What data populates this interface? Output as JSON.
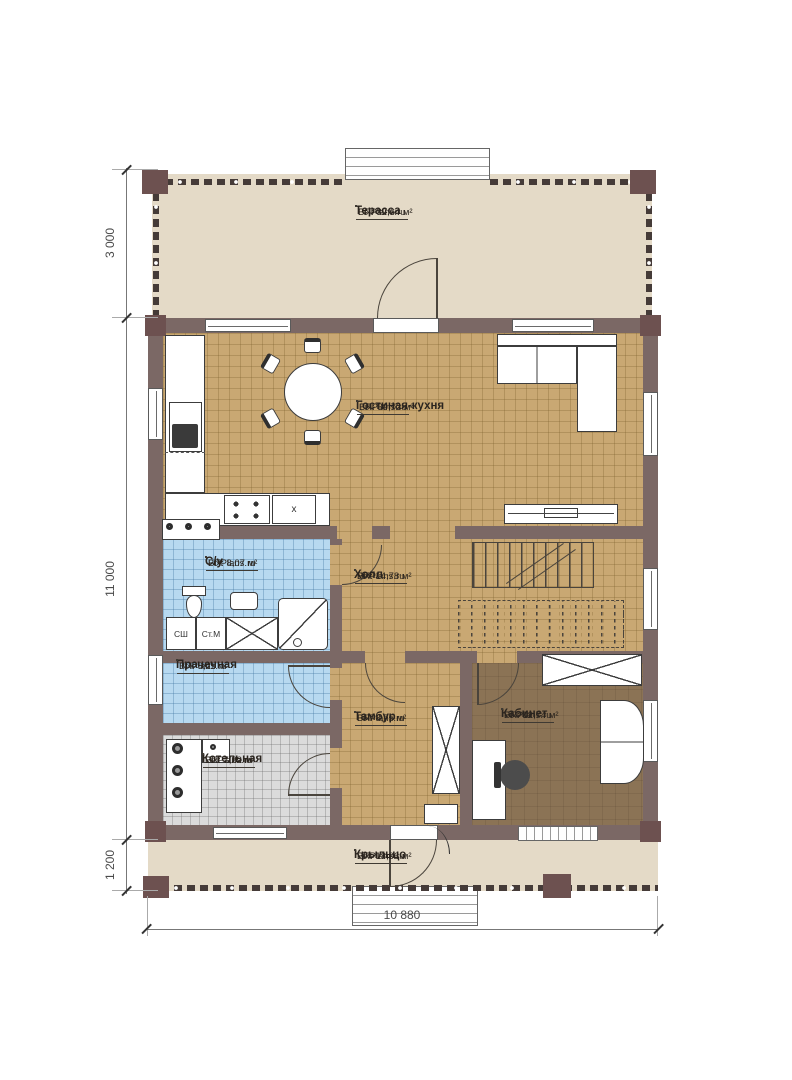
{
  "watermark": "FixPlans.ru",
  "rooms": {
    "terrace": {
      "name": "Терасса",
      "area": "ВП: 32,64 м²"
    },
    "living_kitchen": {
      "name": "Гостиная-кухня",
      "area": "ВП: 39,72 м²"
    },
    "bathroom": {
      "name": "С/у",
      "area": "ВП: 8,07 м²"
    },
    "hall": {
      "name": "Холл",
      "area": "ВП: 14,78 м²"
    },
    "laundry": {
      "name": "Прачечная",
      "area": "ВП: 6,11 м²"
    },
    "vestibule": {
      "name": "Тамбур",
      "area": "ВП: 8,75 м²"
    },
    "office": {
      "name": "Кабинет",
      "area": "ВП: 12,74 м²"
    },
    "boiler_room": {
      "name": "Котельная",
      "area": "ВП: 7,22 м²"
    },
    "porch": {
      "name": "Крыльцо",
      "area": "ВП: 13,06 м²"
    }
  },
  "annotations": {
    "closet": "СШ",
    "washing_machine": "Ст.М",
    "stove_mark": "x"
  },
  "dimensions": {
    "left_top": "3 000",
    "left_middle": "11 000",
    "left_bottom": "1 200",
    "bottom": "10 880"
  },
  "colors": {
    "wall": "#7b6865",
    "corner_post": "#6d5150",
    "floor_wood": "#c9a873",
    "floor_tile_blue": "#b7d9f0",
    "floor_tile_gray": "#dbdbdb",
    "floor_office": "#8b7355",
    "terrace_floor": "#e4dac7"
  }
}
